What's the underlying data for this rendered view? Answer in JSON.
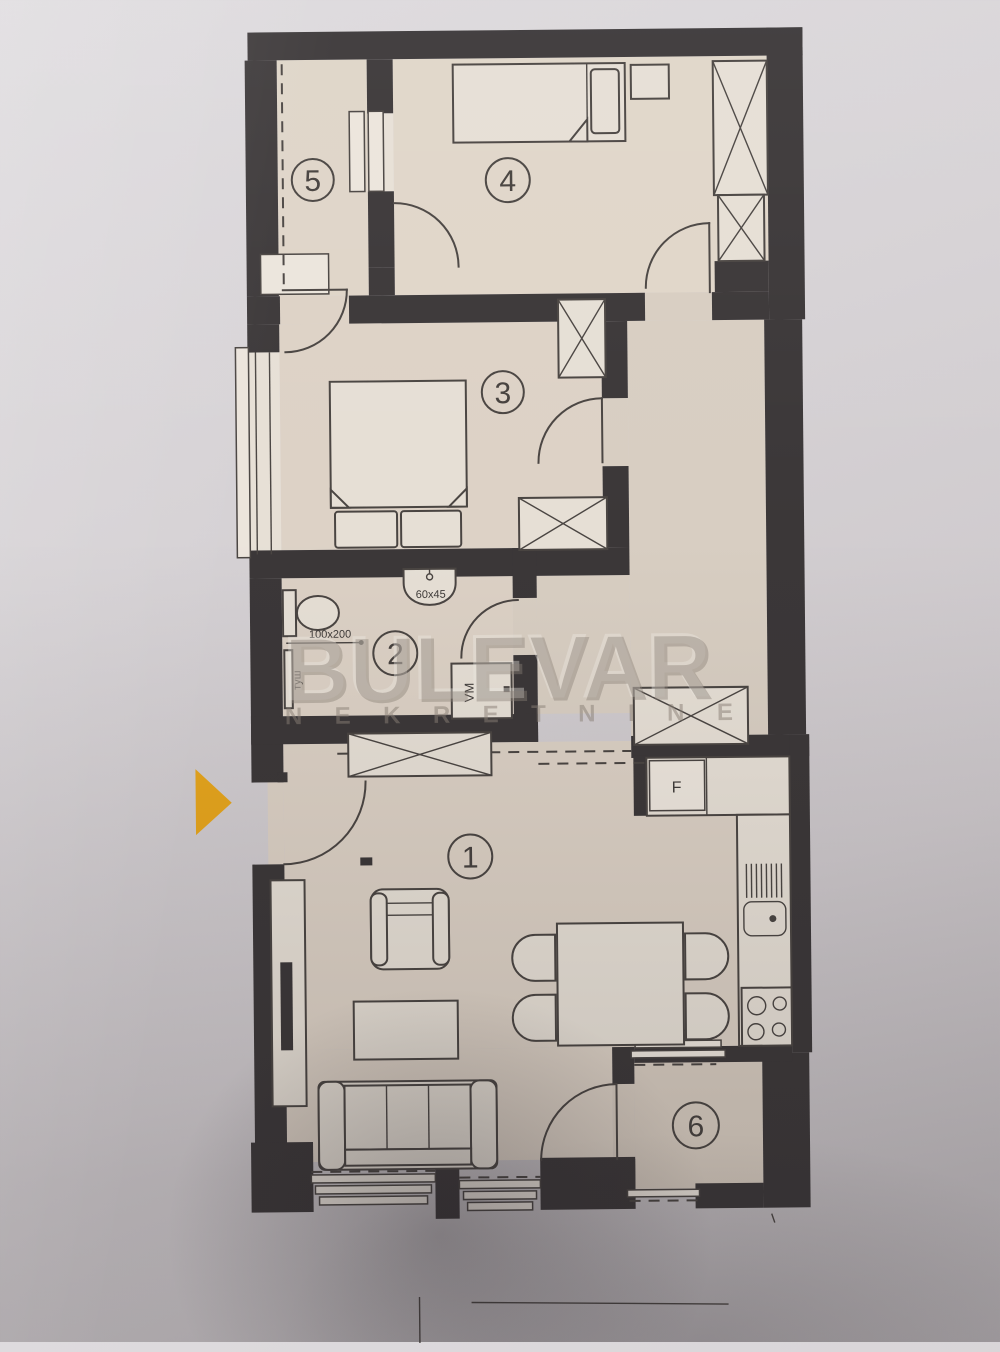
{
  "watermark": {
    "title": "BULEVAR",
    "subtitle": "NEKRETNINE"
  },
  "rooms": [
    {
      "number": "1",
      "name": "living-room-kitchen"
    },
    {
      "number": "2",
      "name": "bathroom"
    },
    {
      "number": "3",
      "name": "bedroom"
    },
    {
      "number": "4",
      "name": "bedroom-2"
    },
    {
      "number": "5",
      "name": "terrace"
    },
    {
      "number": "6",
      "name": "terrace-2"
    }
  ],
  "labels": {
    "sink_dimension": "60x45",
    "shower_dimension": "100x200",
    "shower": "туш",
    "washing_machine": "VM",
    "fridge": "F"
  },
  "colors": {
    "paper": "#d6d2d5",
    "wall": "#3b3738",
    "floor": "#ddd2c6",
    "furniture": "#e6dfd5",
    "line": "#4a4542",
    "watermark": "#8d8379",
    "arrow": "#e6a51c"
  }
}
